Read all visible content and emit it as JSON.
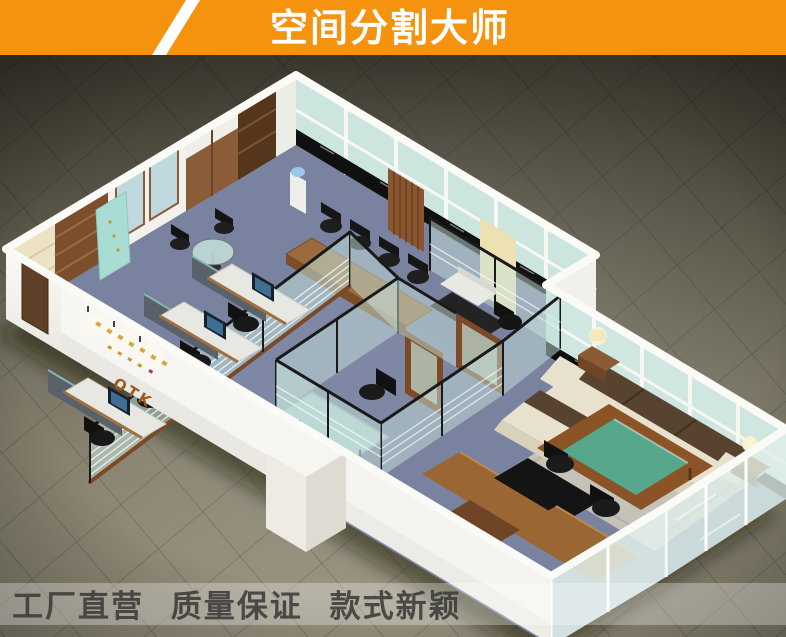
{
  "banner": {
    "title": "空间分割大师",
    "bg_color": "#F5920E",
    "slash_color": "#FFFFFF",
    "title_color": "#FFFFFF"
  },
  "footer": {
    "slogan": "工厂直营 质量保证 款式新颖",
    "text_color": "#3B3B39",
    "band_color": "#FFFFFF"
  },
  "office": {
    "logo_text": "OTK"
  },
  "colors": {
    "floor_dark": "#39362D",
    "floor_light": "#9A9480",
    "carpet": "#79829F",
    "glass_partition": "#C5E2DB",
    "glass_wall": "#CFE7E0",
    "frame_black": "#191919",
    "wall_white": "#F5F4F0",
    "wood": "#9A6734",
    "wood_dark": "#6F4526",
    "sofa_cream": "#E8E1CD",
    "sofa_cushion": "#57432F",
    "coffee_table_green": "#56A78C",
    "marble_black": "#0E0E0E"
  }
}
